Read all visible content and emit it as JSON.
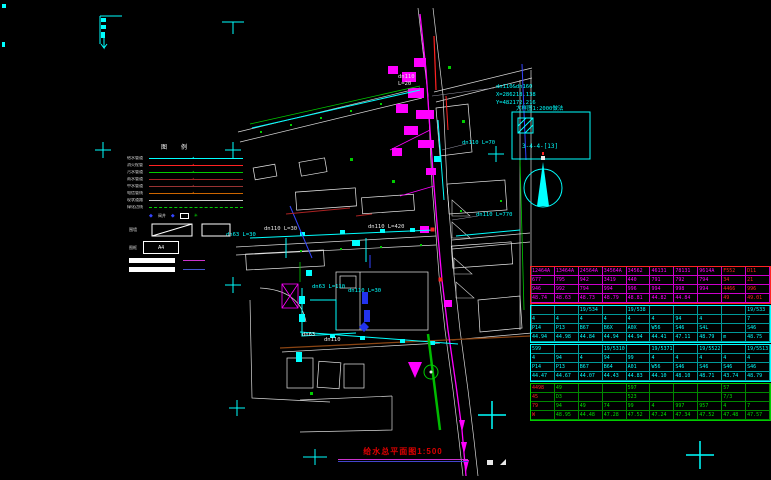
{
  "palette": {
    "cyan": "#00ffff",
    "magenta": "#ff00ff",
    "red": "#ff2222",
    "green": "#00cc00",
    "blue": "#3344ff",
    "white": "#e8e8e8",
    "maroon": "#aa2222",
    "orange": "#cc6600",
    "brown": "#8b4513"
  },
  "legend": {
    "title": "图例",
    "items": [
      {
        "label": "给水管道",
        "color": "#00ffff",
        "dashed": false
      },
      {
        "label": "消火栓管",
        "color": "#ff2222",
        "dashed": false
      },
      {
        "label": "污水管道",
        "color": "#00cc00",
        "dashed": false
      },
      {
        "label": "雨水管道",
        "color": "#aa2222",
        "dashed": false
      },
      {
        "label": "中水管道",
        "color": "#993333",
        "dashed": false
      },
      {
        "label": "电信管线",
        "color": "#cc6600",
        "dashed": false
      },
      {
        "label": "现状道路",
        "color": "#cccccc",
        "dashed": false
      },
      {
        "label": "绿化边线",
        "color": "#00cc00",
        "dashed": true
      }
    ],
    "symbol_row": {
      "d1": "◆",
      "mid": "阀井",
      "d2": "◆",
      "g": "✳"
    },
    "diag_label": "围墙",
    "scale_label": "图框",
    "scale_value": "A4"
  },
  "map": {
    "labels": [
      {
        "text": "dn110&dn160"
      },
      {
        "text": "X=286218.138"
      },
      {
        "text": "Y=482172.216"
      },
      {
        "text": "dn110"
      },
      {
        "text": "L=20"
      },
      {
        "text": "dn110 L=70"
      },
      {
        "text": "dn110 L=770"
      },
      {
        "text": "dn63 L=30"
      },
      {
        "text": "dn110 L=30"
      },
      {
        "text": "dn110 L=420"
      },
      {
        "text": "dn63 L=110"
      },
      {
        "text": "dn110 L=30"
      },
      {
        "text": "dn63"
      },
      {
        "text": "dn110"
      }
    ]
  },
  "detail_box": {
    "header": "大样图1:2000做法",
    "code": "3-4-4-[13]"
  },
  "sheet_title": {
    "text": "给水总平面图1:500"
  },
  "table": {
    "sections": [
      {
        "border": "#ff2222",
        "grid": "#cc00cc",
        "text": "#ff00ff",
        "red_cols": [
          8,
          9
        ],
        "rows": [
          [
            "12464A",
            "13464A",
            "24564A",
            "34564A",
            "34562",
            "46131",
            "78131",
            "9614A",
            "F552",
            "D11"
          ],
          [
            "677",
            "795",
            "942",
            "3419",
            "440",
            "791",
            "792",
            "794",
            "34",
            "21"
          ],
          [
            "946",
            "992",
            "794",
            "994",
            "996",
            "994",
            "998",
            "994",
            "4466",
            "996"
          ],
          [
            "48.74",
            "48.63",
            "48.73",
            "48.79",
            "48.81",
            "44.82",
            "44.84",
            "",
            "49",
            "49.01"
          ]
        ]
      },
      {
        "border": "#00ffff",
        "grid": "#009999",
        "text": "#00ffff",
        "red_cols": [],
        "rows": [
          [
            "",
            "",
            "19/534",
            "",
            "19/538",
            "",
            "",
            "",
            "",
            "19/533"
          ],
          [
            "4",
            "4",
            "4",
            "4",
            "4",
            "4",
            "94",
            "4",
            "",
            "7"
          ],
          [
            "P14",
            "P13",
            "B67",
            "B6X",
            "A0X",
            "W56",
            "S46",
            "S4L",
            "",
            "S46"
          ],
          [
            "44.94",
            "44.98",
            "44.84",
            "44.94",
            "44.94",
            "44.41",
            "47.11",
            "48.79",
            "m",
            "48.75"
          ]
        ]
      },
      {
        "border": "#00ffff",
        "grid": "#009999",
        "text": "#00ffff",
        "red_cols": [],
        "rows": [
          [
            "599",
            "",
            "",
            "19/5310",
            "",
            "19/5371",
            "",
            "19/5522",
            "",
            "19/5513"
          ],
          [
            "4",
            "94",
            "4",
            "94",
            "99",
            "4",
            "4",
            "4",
            "4",
            "4"
          ],
          [
            "P14",
            "P13",
            "B67",
            "B64",
            "A01",
            "W56",
            "S46",
            "S46",
            "S46",
            "S46"
          ],
          [
            "44.47",
            "44.67",
            "44.07",
            "44.43",
            "44.83",
            "44.10",
            "48.10",
            "48.71",
            "43.74",
            "48.79"
          ]
        ]
      },
      {
        "border": "#00cc00",
        "grid": "#008800",
        "text": "#00dd00",
        "red_cols": [
          0
        ],
        "rows": [
          [
            "4498",
            "49",
            "",
            "",
            "597",
            "",
            "",
            "",
            "57",
            ""
          ],
          [
            "45",
            "D3",
            "",
            "",
            "523",
            "",
            "",
            "",
            "7/3",
            ""
          ],
          [
            "79",
            "94",
            "49",
            "74",
            "99",
            "4",
            "997",
            "957",
            "4",
            "7"
          ],
          [
            "W",
            "48.95",
            "44.48",
            "47.28",
            "47.52",
            "47.24",
            "47.34",
            "47.52",
            "47.48",
            "47.57"
          ]
        ]
      }
    ]
  }
}
